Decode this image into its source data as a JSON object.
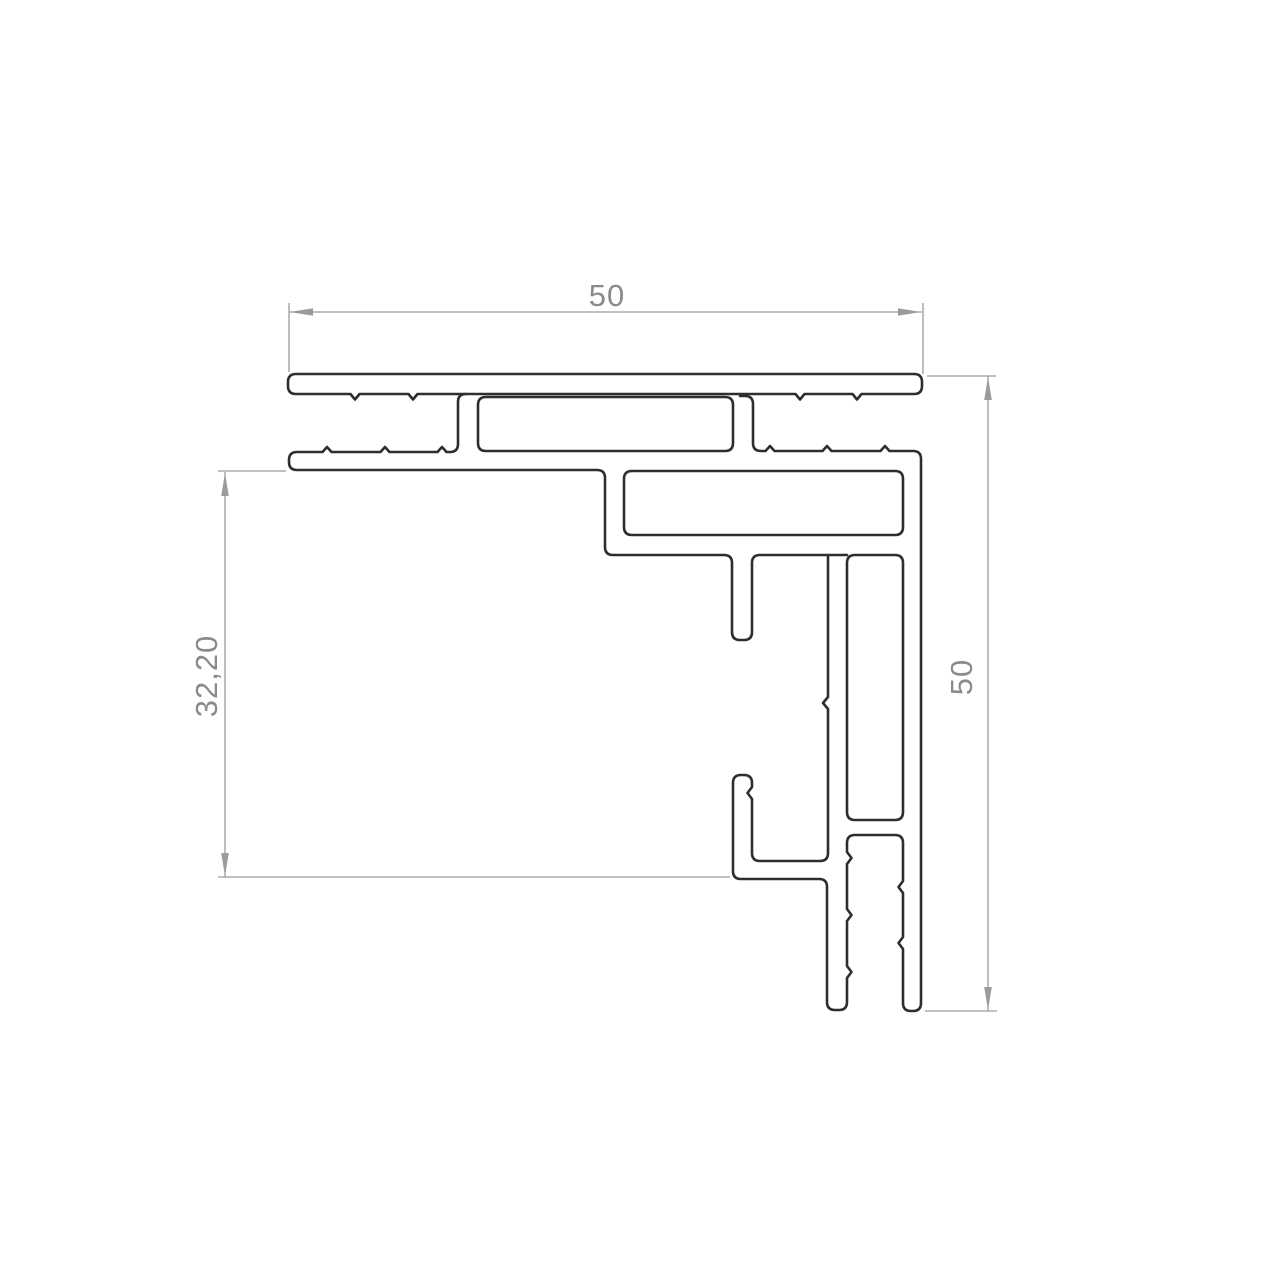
{
  "page": {
    "background": "#ffffff"
  },
  "drawing": {
    "description": "Aluminium profile corner cross-section technical drawing",
    "profile_line_color": "#2e2e2e",
    "dimension_line_color": "#9b9b9b",
    "dimension_text_color": "#8a8a8a",
    "dimensions": {
      "top_width": "50",
      "right_height": "50",
      "left_height": "32,20"
    }
  }
}
